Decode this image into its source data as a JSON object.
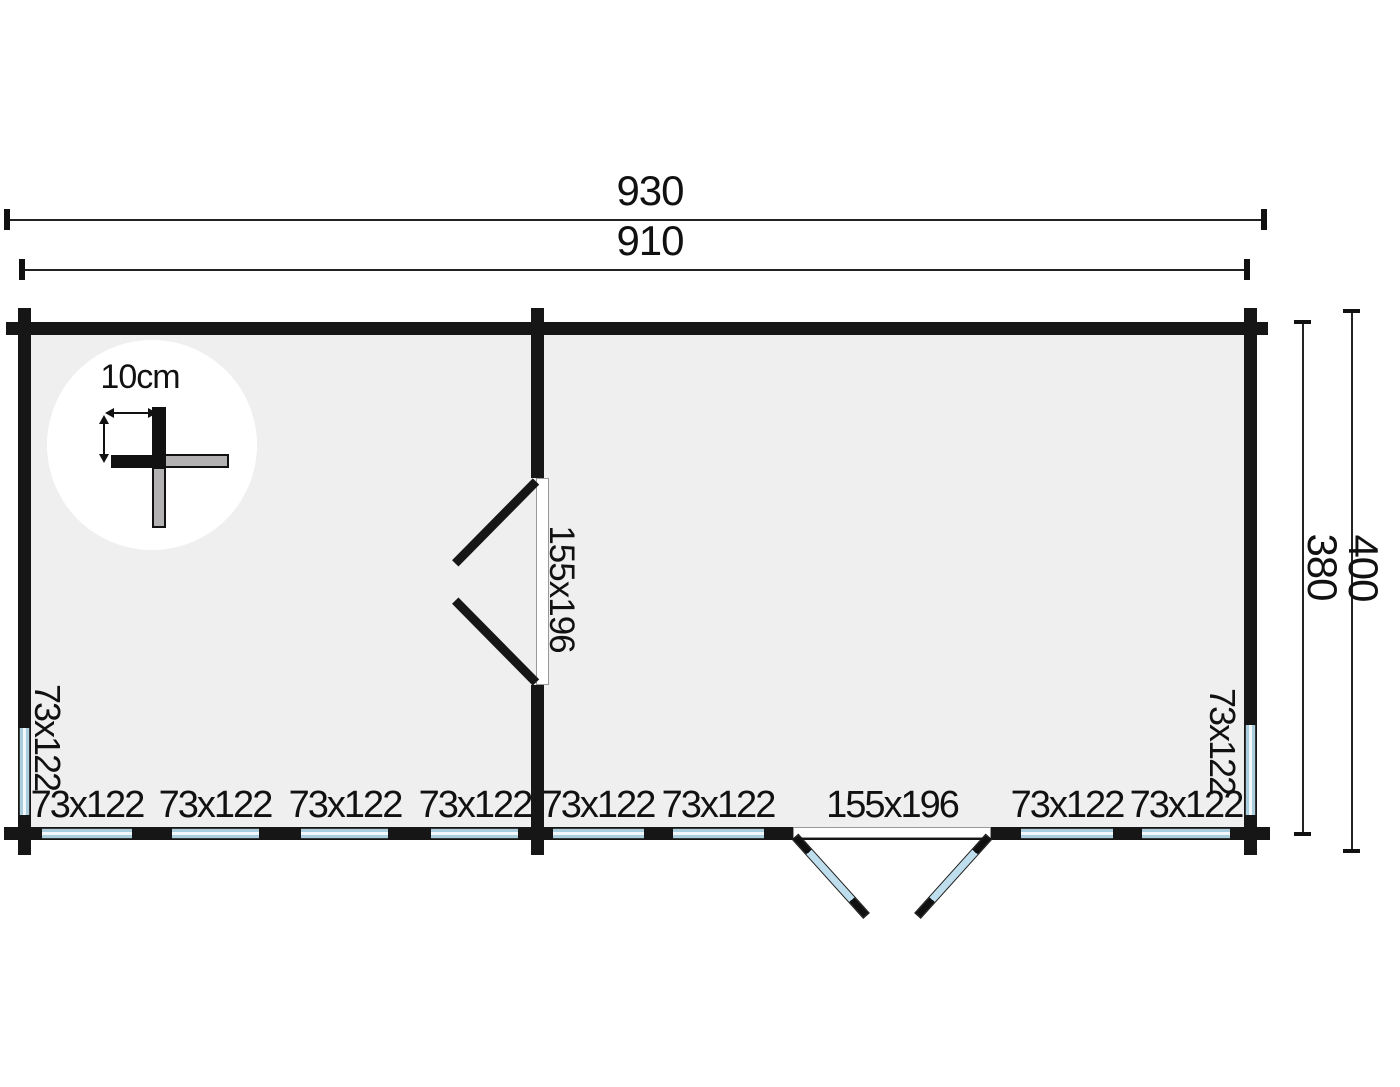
{
  "figure": {
    "type": "log-cabin-floor-plan"
  },
  "dimensions": {
    "overall_width": "930",
    "inner_width": "910",
    "inner_depth": "380",
    "overall_depth": "400",
    "wall_thickness": "10cm"
  },
  "openings": {
    "interior_door": "155x196",
    "exterior_door": "155x196",
    "left_window": "73x122",
    "right_window": "73x122",
    "bottom_windows": [
      "73x122",
      "73x122",
      "73x122",
      "73x122",
      "73x122",
      "73x122",
      "73x122",
      "73x122"
    ]
  },
  "colors": {
    "wall": "#161616",
    "floor": "#efefef",
    "glass": "#a9cede",
    "dimension_line": "#222222"
  }
}
